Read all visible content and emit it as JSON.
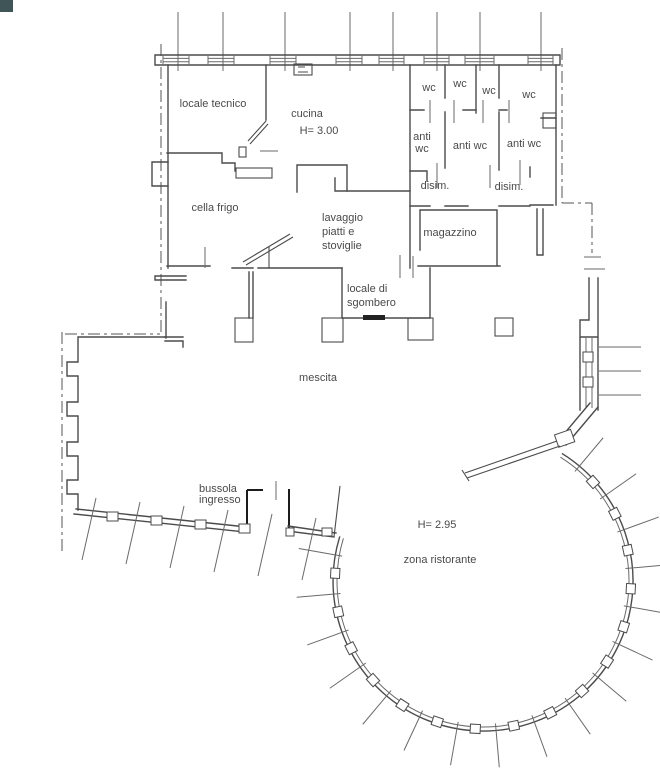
{
  "document": {
    "kind": "architectural floor plan",
    "language": "Italian",
    "background_color": "#ffffff",
    "line_color": "#4b4b4b",
    "text_color": "#4a4a4a",
    "corner_mark_color": "#3f5557"
  },
  "labels": {
    "locale_tecnico": "locale tecnico",
    "cucina": "cucina",
    "cucina_height": "H= 3.00",
    "wc": "wc",
    "anti": "anti",
    "anti_wc": "anti wc",
    "disim": "disim.",
    "cella_frigo": "cella frigo",
    "lavaggio_1": "lavaggio",
    "lavaggio_2": "piatti e",
    "lavaggio_3": "stoviglie",
    "magazzino": "magazzino",
    "sgombero_1": "locale di",
    "sgombero_2": "sgombero",
    "mescita": "mescita",
    "bussola_1": "bussola",
    "bussola_2": "ingresso",
    "ristorante_height": "H= 2.95",
    "zona_ristorante": "zona ristorante"
  },
  "rooms": [
    {
      "id": "locale-tecnico",
      "label": "locale tecnico"
    },
    {
      "id": "cucina",
      "label": "cucina",
      "height_note": "H= 3.00"
    },
    {
      "id": "wc",
      "label": "wc",
      "count": 4
    },
    {
      "id": "anti-wc",
      "label": "anti wc",
      "count": 3
    },
    {
      "id": "disimpegno",
      "label": "disim.",
      "count": 2
    },
    {
      "id": "cella-frigo",
      "label": "cella frigo"
    },
    {
      "id": "lavaggio",
      "label": "lavaggio piatti e stoviglie"
    },
    {
      "id": "magazzino",
      "label": "magazzino"
    },
    {
      "id": "locale-di-sgombero",
      "label": "locale di sgombero"
    },
    {
      "id": "mescita",
      "label": "mescita"
    },
    {
      "id": "bussola-ingresso",
      "label": "bussola ingresso"
    },
    {
      "id": "zona-ristorante",
      "label": "zona ristorante",
      "height_note": "H= 2.95"
    }
  ]
}
